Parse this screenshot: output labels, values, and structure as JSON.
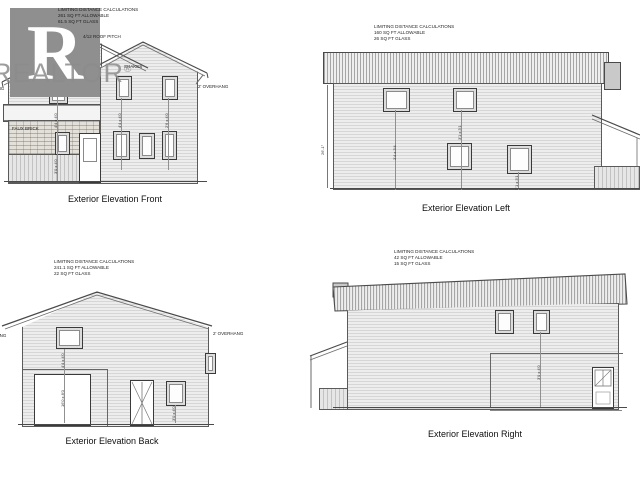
{
  "logo": {
    "brand": "REALTOR",
    "registered": "®"
  },
  "front": {
    "caption": "Exterior Elevation Front",
    "calc_title": "LIMITING DISTANCE CALCULATIONS",
    "calc_allowable": "261 SQ FT ALLOWABLE",
    "calc_glass": "61.5 SQ FT GLASS",
    "roof_pitch": "4/12 ROOF PITCH",
    "shakes_upper": "SHAKES",
    "shakes_lower": "SHAKES",
    "overhang_right": "2' OVERHANG",
    "overhang_left_clipped": "2' OVERHANG",
    "faux_brick": "FAUX BRICK",
    "dim_upper_left": "4'4 x 4'0",
    "dim_upper_mid": "4'4 x 4'0",
    "dim_upper_right": "2'6 x 4'0",
    "dim_garage_window": "3'0 x 4'0"
  },
  "left": {
    "caption": "Exterior Elevation Left",
    "calc_title": "LIMITING DISTANCE CALCULATIONS",
    "calc_allowable": "160 SQ FT ALLOWABLE",
    "calc_glass": "26 SQ FT GLASS",
    "height_dim": "26'-1\"",
    "dim_win_a": "3'4 x 3'4",
    "dim_win_b": "3'1 x 3'1",
    "dim_win_c": "3'1 x 3'1"
  },
  "back": {
    "caption": "Exterior Elevation Back",
    "calc_title": "LIMITING DISTANCE CALCULATIONS",
    "calc_allowable": "241.1 SQ FT ALLOWABLE",
    "calc_glass": "22 SQ FT GLASS",
    "overhang_left": "2' OVERHANG",
    "overhang_right": "2' OVERHANG",
    "dim_upper": "4'4 x 4'0",
    "dim_garage": "16'0 x 8'0",
    "dim_window": "3'0 x 4'0"
  },
  "right": {
    "caption": "Exterior Elevation Right",
    "calc_title": "LIMITING DISTANCE CALCULATIONS",
    "calc_allowable": "42 SQ FT ALLOWABLE",
    "calc_glass": "15 SQ FT GLASS",
    "dim_wall": "3'0 x 4'0"
  }
}
